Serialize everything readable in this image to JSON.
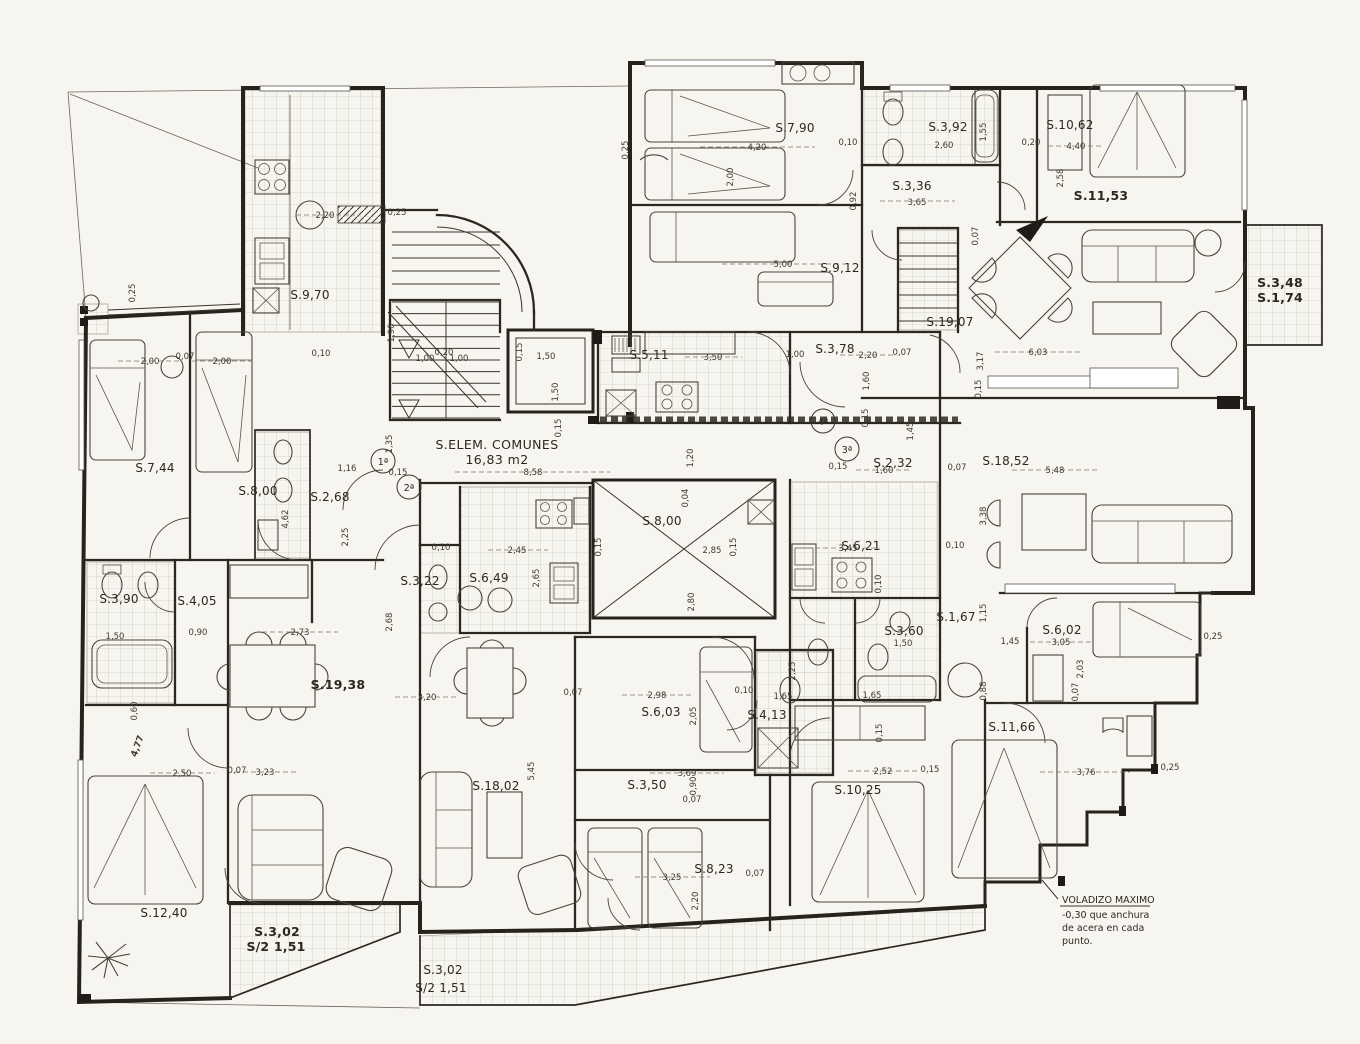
{
  "document": {
    "common_area": {
      "label": "S.ELEM. COMUNES",
      "value": "16,83 m2"
    },
    "note": {
      "line1": "VOLADIZO MAXIMO",
      "line2": "-0,30 que anchura",
      "line3": "de acera en cada",
      "line4": "punto."
    },
    "unit_markers": [
      {
        "t": "1ª"
      },
      {
        "t": "2ª"
      },
      {
        "t": "3ª"
      },
      {
        "t": "4ª"
      }
    ],
    "colors": {
      "paper": "#f7f5f0",
      "ink": "#26231d",
      "tile": "#b9b5ac",
      "dim_text": "#3f3a30"
    }
  },
  "rooms": [
    {
      "label": "S.7,90"
    },
    {
      "label": "S.3,92"
    },
    {
      "label": "S.10,62"
    },
    {
      "label": "S.3,36"
    },
    {
      "label": "S.11,53"
    },
    {
      "label": "S.9,12"
    },
    {
      "label": "S.3,48"
    },
    {
      "label": "S.1,74"
    },
    {
      "label": "S.9,70"
    },
    {
      "label": "S.19,07"
    },
    {
      "label": "S.3,78"
    },
    {
      "label": "S.5,11"
    },
    {
      "label": "S.2,32"
    },
    {
      "label": "S.18,52"
    },
    {
      "label": "S.7,44"
    },
    {
      "label": "S.8,00"
    },
    {
      "label": "S.2,68"
    },
    {
      "label": "S.8,00"
    },
    {
      "label": "S.6,21"
    },
    {
      "label": "S.6,49"
    },
    {
      "label": "S.3,22"
    },
    {
      "label": "S.3,90"
    },
    {
      "label": "S.4,05"
    },
    {
      "label": "S.1,67"
    },
    {
      "label": "S.3,60"
    },
    {
      "label": "S.6,02"
    },
    {
      "label": "S.19,38"
    },
    {
      "label": "S.6,03"
    },
    {
      "label": "S.4,13"
    },
    {
      "label": "S.11,66"
    },
    {
      "label": "S.18,02"
    },
    {
      "label": "S.3,50"
    },
    {
      "label": "S.10,25"
    },
    {
      "label": "S.8,23"
    },
    {
      "label": "S.12,40"
    },
    {
      "label": "S.3,02"
    },
    {
      "label": "S/2 1,51"
    },
    {
      "label": "S.3,02"
    },
    {
      "label": "S/2 1,51"
    }
  ],
  "dims": [
    {
      "t": "0,25"
    },
    {
      "t": "4,20"
    },
    {
      "t": "2,00"
    },
    {
      "t": "0,10"
    },
    {
      "t": "2,60"
    },
    {
      "t": "1,55"
    },
    {
      "t": "0,20"
    },
    {
      "t": "4,40"
    },
    {
      "t": "2,58"
    },
    {
      "t": "0,92"
    },
    {
      "t": "3,65"
    },
    {
      "t": "5,00"
    },
    {
      "t": "2,20"
    },
    {
      "t": "0,25"
    },
    {
      "t": "0,25"
    },
    {
      "t": "2,00"
    },
    {
      "t": "0,07"
    },
    {
      "t": "2,00"
    },
    {
      "t": "1,96"
    },
    {
      "t": "1,00"
    },
    {
      "t": "0,20"
    },
    {
      "t": "1,00"
    },
    {
      "t": "1,35"
    },
    {
      "t": "1,50"
    },
    {
      "t": "0,15"
    },
    {
      "t": "1,50"
    },
    {
      "t": "3,50"
    },
    {
      "t": "1,00"
    },
    {
      "t": "2,20"
    },
    {
      "t": "0,07"
    },
    {
      "t": "1,60"
    },
    {
      "t": "3,17"
    },
    {
      "t": "6,03"
    },
    {
      "t": "0,07"
    },
    {
      "t": "1,45"
    },
    {
      "t": "0,15"
    },
    {
      "t": "1,60"
    },
    {
      "t": "0,07"
    },
    {
      "t": "5,48"
    },
    {
      "t": "3,38"
    },
    {
      "t": "1,16"
    },
    {
      "t": "0,15"
    },
    {
      "t": "2,25"
    },
    {
      "t": "4,62"
    },
    {
      "t": "8,58"
    },
    {
      "t": "1,20"
    },
    {
      "t": "0,04"
    },
    {
      "t": "2,45"
    },
    {
      "t": "0,10"
    },
    {
      "t": "0,15"
    },
    {
      "t": "2,85"
    },
    {
      "t": "0,15"
    },
    {
      "t": "2,65"
    },
    {
      "t": "2,80"
    },
    {
      "t": "3,45"
    },
    {
      "t": "0,10"
    },
    {
      "t": "0,10"
    },
    {
      "t": "1,50"
    },
    {
      "t": "1,65"
    },
    {
      "t": "1,45"
    },
    {
      "t": "3,05"
    },
    {
      "t": "2,03"
    },
    {
      "t": "1,15"
    },
    {
      "t": "0,88"
    },
    {
      "t": "0,25"
    },
    {
      "t": "3,20"
    },
    {
      "t": "5,45"
    },
    {
      "t": "0,07"
    },
    {
      "t": "2,98"
    },
    {
      "t": "2,05"
    },
    {
      "t": "1,65"
    },
    {
      "t": "2,25"
    },
    {
      "t": "3,69"
    },
    {
      "t": "0,90"
    },
    {
      "t": "0,07"
    },
    {
      "t": "3,25"
    },
    {
      "t": "2,20"
    },
    {
      "t": "0,07"
    },
    {
      "t": "2,52"
    },
    {
      "t": "0,15"
    },
    {
      "t": "3,76"
    },
    {
      "t": "0,25"
    },
    {
      "t": "2,50"
    },
    {
      "t": "0,07"
    },
    {
      "t": "3,23"
    },
    {
      "t": "2,73"
    },
    {
      "t": "0,90"
    },
    {
      "t": "1,50"
    },
    {
      "t": "0,60"
    },
    {
      "t": "4,77"
    },
    {
      "t": "2,68"
    },
    {
      "t": "0,15"
    },
    {
      "t": "0,10"
    },
    {
      "t": "0,15"
    },
    {
      "t": "0,15"
    },
    {
      "t": "0,07"
    },
    {
      "t": "0,15"
    },
    {
      "t": "0,10"
    }
  ]
}
